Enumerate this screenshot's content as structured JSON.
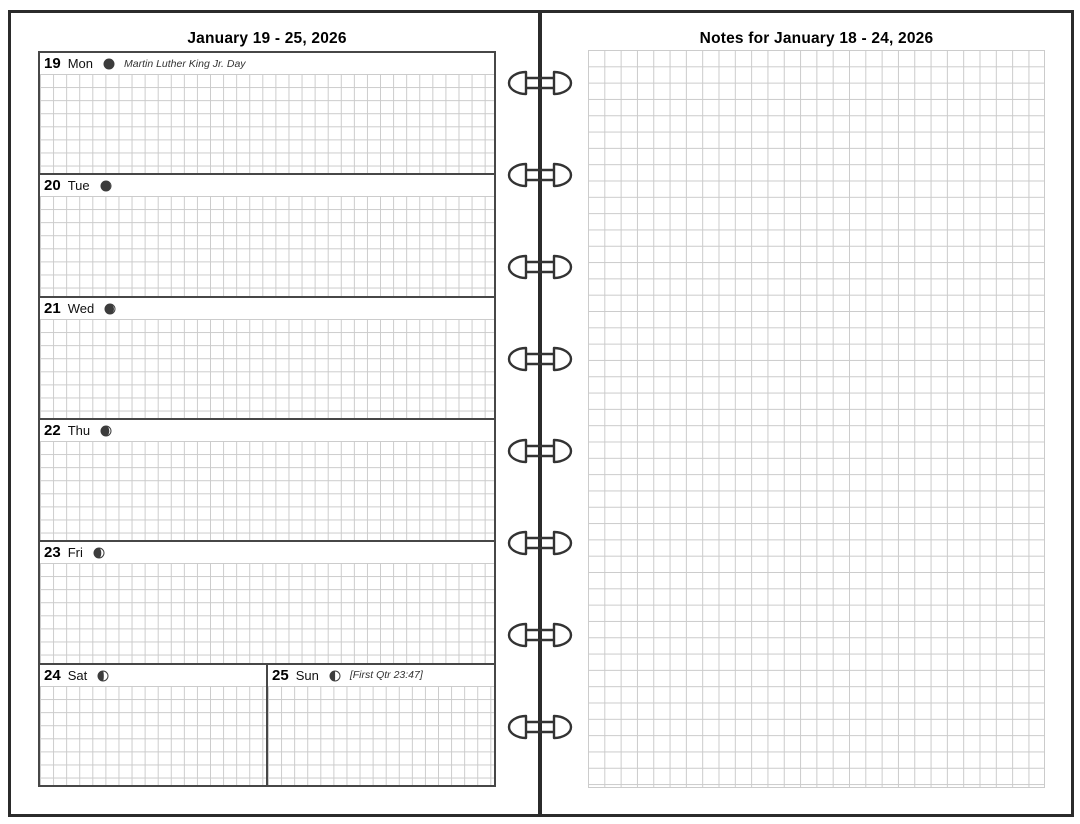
{
  "left_page": {
    "title": "January 19 - 25, 2026",
    "days": [
      {
        "num": "19",
        "name": "Mon",
        "note": "Martin Luther King Jr. Day",
        "moon_fraction": 0.01
      },
      {
        "num": "20",
        "name": "Tue",
        "note": "",
        "moon_fraction": 0.05
      },
      {
        "num": "21",
        "name": "Wed",
        "note": "",
        "moon_fraction": 0.1
      },
      {
        "num": "22",
        "name": "Thu",
        "note": "",
        "moon_fraction": 0.17
      },
      {
        "num": "23",
        "name": "Fri",
        "note": "",
        "moon_fraction": 0.27
      },
      {
        "num": "24",
        "name": "Sat",
        "note": "",
        "moon_fraction": 0.42
      },
      {
        "num": "25",
        "name": "Sun",
        "note": "[First Qtr 23:47]",
        "moon_fraction": 0.49
      }
    ]
  },
  "right_page": {
    "title": "Notes for January 18 - 24, 2026"
  },
  "binder": {
    "ring_count": 8
  },
  "colors": {
    "frame": "#2b2b2b",
    "box_border": "#474747",
    "grid_line": "#cbcbcb",
    "moon": "#3c3c3c",
    "ring": "#333333"
  }
}
